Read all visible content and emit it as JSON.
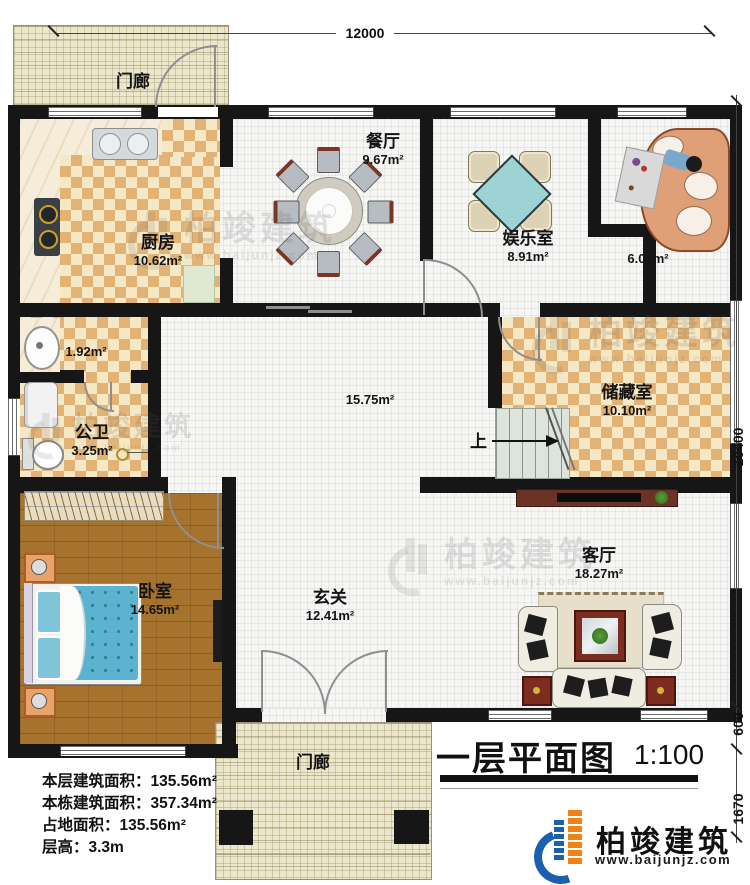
{
  "plan": {
    "title": "一层平面图",
    "scale": "1:100",
    "up": "上"
  },
  "dims": {
    "top": "12000",
    "right_total": "10400",
    "right_seg1": "600",
    "right_seg2": "1670"
  },
  "rooms": {
    "porch_top": {
      "name": "门廊"
    },
    "porch_bottom": {
      "name": "门廊"
    },
    "kitchen": {
      "name": "厨房",
      "area": "10.62m²"
    },
    "dining": {
      "name": "餐厅",
      "area": "9.67m²"
    },
    "recreation": {
      "name": "娱乐室",
      "area": "8.91m²"
    },
    "lounge": {
      "area": "6.07m²"
    },
    "utility": {
      "area": "1.92m²"
    },
    "bathroom": {
      "name": "公卫",
      "area": "3.25m²"
    },
    "hall": {
      "area": "15.75m²"
    },
    "storage": {
      "name": "储藏室",
      "area": "10.10m²"
    },
    "bedroom": {
      "name": "卧室",
      "area": "14.65m²"
    },
    "foyer": {
      "name": "玄关",
      "area": "12.41m²"
    },
    "living": {
      "name": "客厅",
      "area": "18.27m²"
    }
  },
  "stats": {
    "line1": "本层建筑面积：135.56m²",
    "line2": "本栋建筑面积：357.34m²",
    "line3": "占地面积：135.56m²",
    "line4": "层高：3.3m"
  },
  "branding": {
    "logo_text": "柏竣建筑",
    "logo_url": "www.baijunjz.com"
  },
  "watermark": {
    "text": "柏竣建筑",
    "url": "www.baijunjz.com"
  }
}
